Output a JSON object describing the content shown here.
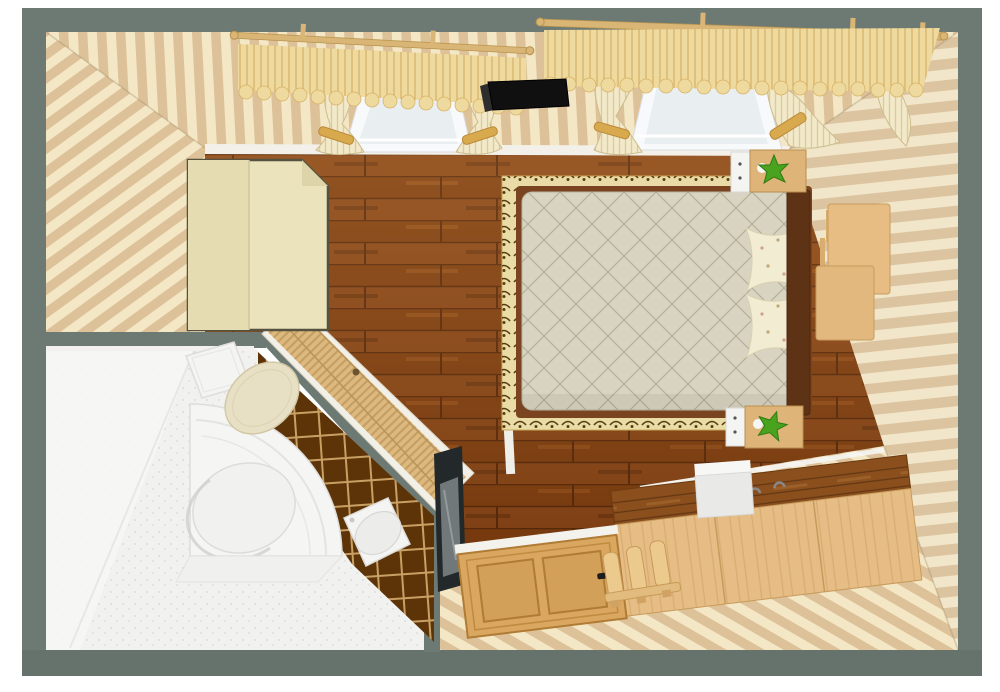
{
  "scene": {
    "kind": "3d-floorplan-render",
    "view": "top-down perspective (dollhouse view)",
    "rooms": [
      {
        "name": "bedroom",
        "floor": "dark wood planks",
        "walls": "striped cream wallpaper with grey wall caps",
        "objects": [
          "corner-wardrobe",
          "double-bed",
          "quilted-duvet",
          "pillow-top",
          "pillow-bottom",
          "area-rug",
          "nightstand-top",
          "nightstand-bottom",
          "plant-top",
          "plant-bottom",
          "window-left",
          "window-right",
          "curtains",
          "valances",
          "curtain-rods",
          "wall-tv",
          "desk",
          "chest-of-drawers",
          "storage-box",
          "entry-door",
          "slatted-bench",
          "wall-mirror",
          "bathroom-door"
        ]
      },
      {
        "name": "bathroom",
        "floor": "white stone",
        "walls": "white plaster with dark brown tile wall",
        "objects": [
          "corner-bathtub",
          "toilet",
          "bidet",
          "tile-wall"
        ]
      }
    ]
  },
  "colors": {
    "page_bg": "#ffffff",
    "frame": "#6d7a73",
    "frame_bottom": "#66736c",
    "wp_light": "#f3e7c5",
    "wp_dark": "#ddc198",
    "baseboard": "#f2f0e8",
    "floor_wood": "#82400f",
    "bathroom_floor": "#f1f1ef",
    "bathroom_wall": "#f7f7f5",
    "tile_brown": "#5d3408",
    "tile_grout": "#c9a063",
    "tub_white": "#f5f5f4",
    "toilet_lid": "#e8e0c4",
    "fixture_white": "#f4f4f3",
    "wardrobe_cream": "#ebe3bb",
    "wardrobe_outline": "#55523f",
    "rug_base": "#e9dca6",
    "rug_field": "#f0e5b4",
    "rug_motif": "#5a3c12",
    "rug_trim": "#c2a145",
    "bed_frame": "#7a4420",
    "headboard": "#5e3315",
    "duvet": "#d8d4c1",
    "quilt_line": "#b4ae96",
    "pillow": "#f2ecd2",
    "nightstand_wood": "#dfb478",
    "nightstand_front": "#f4f4f3",
    "plant_green": "#49a31e",
    "plant_dark": "#2f7a12",
    "window_frame": "#f7f9fa",
    "window_glass": "#e9eef1",
    "curtain": "#f1e9c9",
    "valance_gold": "#eeda9e",
    "rod_tan": "#d9b576",
    "tv_black": "#101010",
    "tv_side": "#2e2e2e",
    "desk_wood": "#e7bd83",
    "dresser_top": "#8a4f1d",
    "dresser_front": "#e6bd85",
    "dresser_line": "#c79b5c",
    "white_box": "#e9e9e8",
    "door_wood": "#d9a75f",
    "door_line": "#b07c35",
    "handle_dark": "#1c1c1c",
    "bench_wood": "#ecc98d",
    "bath_door_wood": "#ddb97e",
    "bath_door_frame": "#f2efe6",
    "mirror_frame": "#23282a",
    "mirror_glass": "#70787a"
  }
}
